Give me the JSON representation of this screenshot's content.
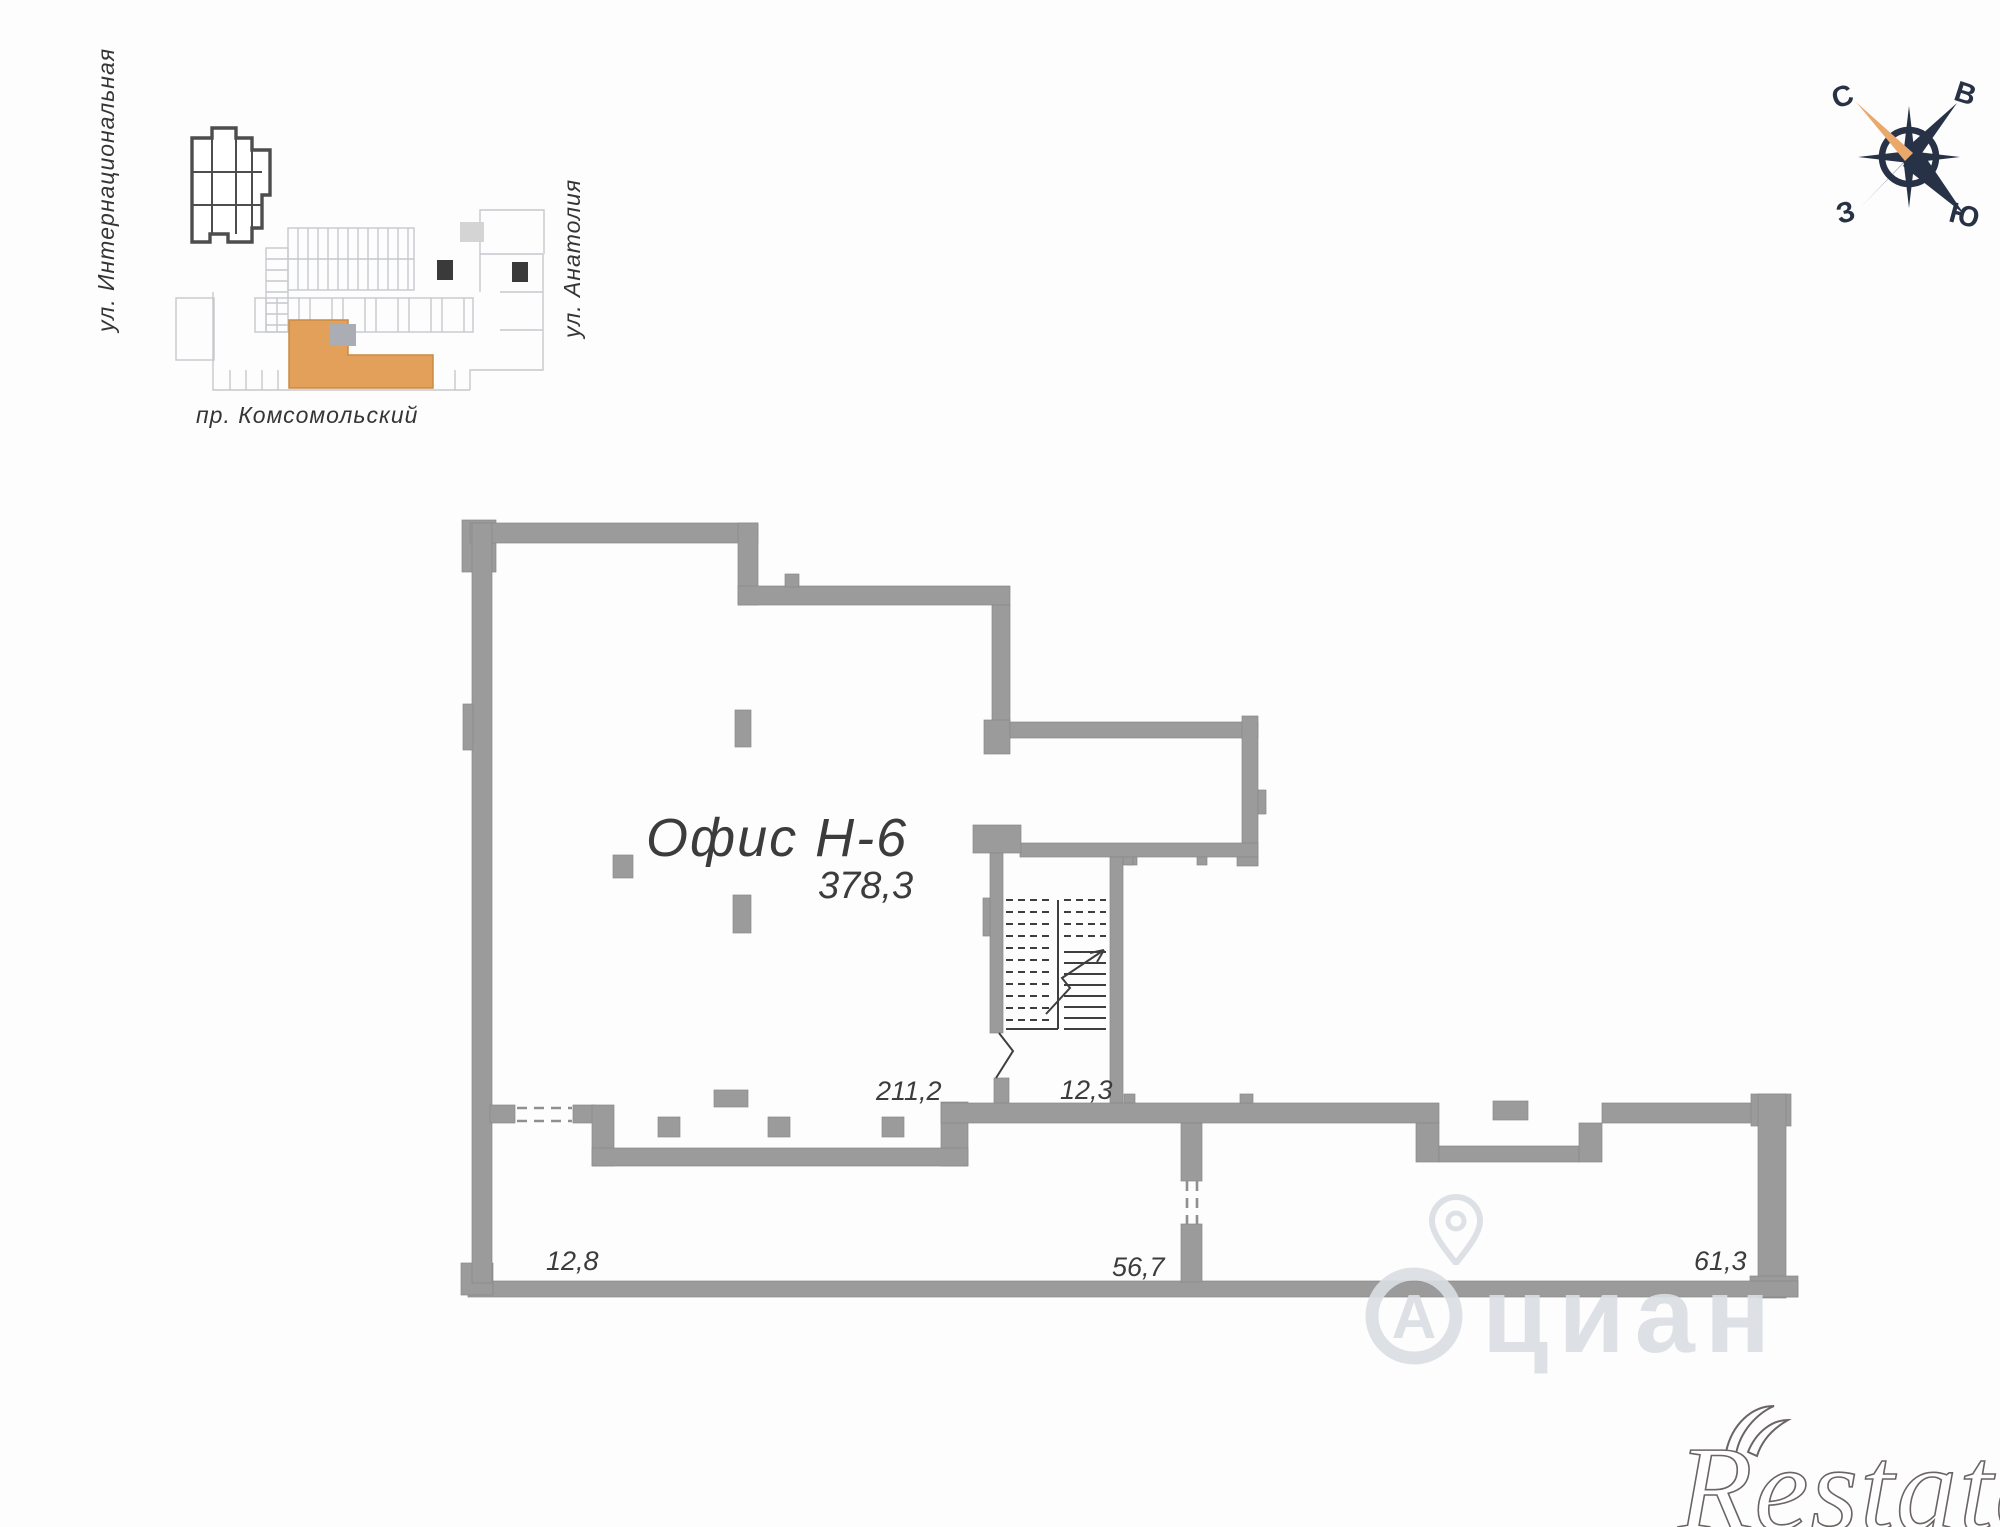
{
  "map": {
    "street_left": "ул. Интернациональная",
    "street_right": "ул. Анатолия",
    "street_bottom": "пр. Комсомольский"
  },
  "compass": {
    "n": "С",
    "e": "В",
    "s": "Ю",
    "w": "З"
  },
  "plan": {
    "title": "Офис Н-6",
    "total_area": "378,3",
    "rooms": [
      {
        "label": "211,2"
      },
      {
        "label": "12,3"
      },
      {
        "label": "12,8"
      },
      {
        "label": "56,7"
      },
      {
        "label": "61,3"
      }
    ]
  },
  "watermarks": {
    "cian_logo_letter": "А",
    "cian": "циан",
    "restate": "Restate"
  },
  "colors": {
    "wall": "#9b9b9b",
    "plan_line": "#3e3e3e",
    "highlight_orange": "#e2a05b",
    "compass_navy": "#273246",
    "compass_needle": "#eaa96b",
    "watermark_gray": "#dadfe4"
  }
}
